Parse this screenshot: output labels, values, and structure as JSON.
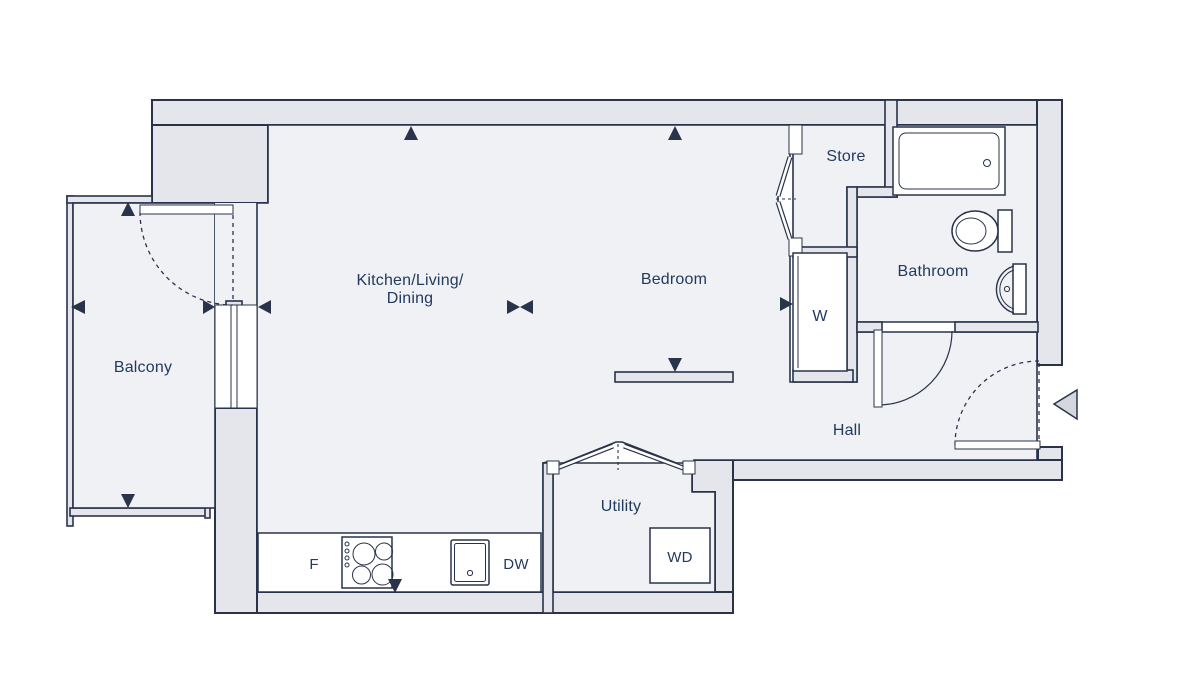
{
  "colors": {
    "page": "#ffffff",
    "wall": "#e4e6eb",
    "floor": "#f0f1f5",
    "line": "#29334a",
    "text": "#223a5e",
    "white": "#ffffff",
    "arrow": "#d4d7dd"
  },
  "rooms": {
    "kitchen_living_dining": {
      "line1": "Kitchen/Living/",
      "line2": "Dining"
    },
    "bedroom": "Bedroom",
    "balcony": "Balcony",
    "store": "Store",
    "bathroom": "Bathroom",
    "hall": "Hall",
    "utility": "Utility"
  },
  "fixtures": {
    "wardrobe": "W",
    "fridge": "F",
    "dishwasher": "DW",
    "washer_dryer": "WD"
  }
}
